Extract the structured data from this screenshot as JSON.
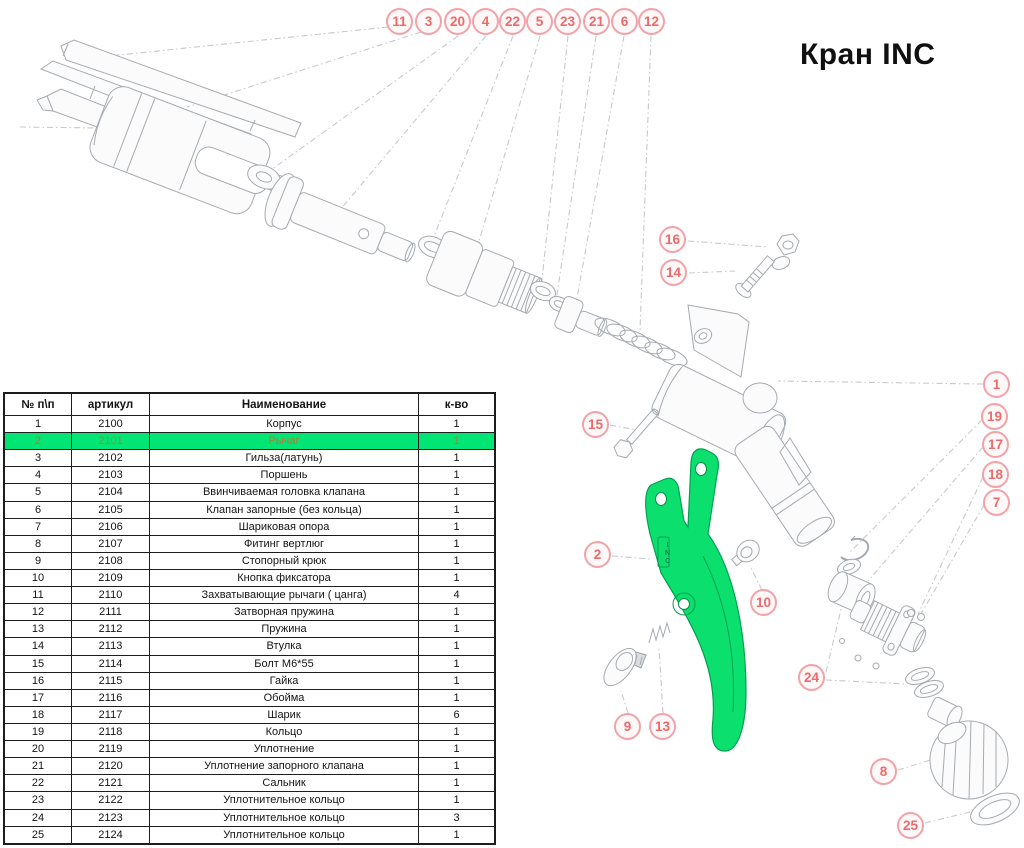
{
  "title": "Кран INC",
  "table": {
    "columns": [
      "№ п\\п",
      "артикул",
      "Наименование",
      "к-во"
    ],
    "highlighted_row_number": 2,
    "rows": [
      [
        1,
        "2100",
        "Корпус",
        "1"
      ],
      [
        2,
        "2101",
        "Рычаг",
        "1"
      ],
      [
        3,
        "2102",
        "Гильза(латунь)",
        "1"
      ],
      [
        4,
        "2103",
        "Поршень",
        "1"
      ],
      [
        5,
        "2104",
        "Ввинчиваемая головка клапана",
        "1"
      ],
      [
        6,
        "2105",
        "Клапан запорные (без кольца)",
        "1"
      ],
      [
        7,
        "2106",
        "Шариковая опора",
        "1"
      ],
      [
        8,
        "2107",
        "Фитинг вертлюг",
        "1"
      ],
      [
        9,
        "2108",
        "Стопорный крюк",
        "1"
      ],
      [
        10,
        "2109",
        "Кнопка фиксатора",
        "1"
      ],
      [
        11,
        "2110",
        "Захватывающие рычаги ( цанга)",
        "4"
      ],
      [
        12,
        "2111",
        "Затворная пружина",
        "1"
      ],
      [
        13,
        "2112",
        "Пружина",
        "1"
      ],
      [
        14,
        "2113",
        "Втулка",
        "1"
      ],
      [
        15,
        "2114",
        "Болт М6*55",
        "1"
      ],
      [
        16,
        "2115",
        "Гайка",
        "1"
      ],
      [
        17,
        "2116",
        "Обойма",
        "1"
      ],
      [
        18,
        "2117",
        "Шарик",
        "6"
      ],
      [
        19,
        "2118",
        "Кольцо",
        "1"
      ],
      [
        20,
        "2119",
        "Уплотнение",
        "1"
      ],
      [
        21,
        "2120",
        "Уплотнение запорного клапана",
        "1"
      ],
      [
        22,
        "2121",
        "Сальник",
        "1"
      ],
      [
        23,
        "2122",
        "Уплотнительное кольцо",
        "1"
      ],
      [
        24,
        "2123",
        "Уплотнительное кольцо",
        "3"
      ],
      [
        25,
        "2124",
        "Уплотнительное кольцо",
        "1"
      ]
    ]
  },
  "callouts": [
    {
      "label": "11",
      "x": 400,
      "y": 22
    },
    {
      "label": "3",
      "x": 429,
      "y": 22
    },
    {
      "label": "20",
      "x": 458,
      "y": 22
    },
    {
      "label": "4",
      "x": 486,
      "y": 22
    },
    {
      "label": "22",
      "x": 513,
      "y": 22
    },
    {
      "label": "5",
      "x": 540,
      "y": 22
    },
    {
      "label": "23",
      "x": 568,
      "y": 22
    },
    {
      "label": "21",
      "x": 597,
      "y": 22
    },
    {
      "label": "6",
      "x": 625,
      "y": 22
    },
    {
      "label": "12",
      "x": 652,
      "y": 22
    },
    {
      "label": "16",
      "x": 673,
      "y": 240
    },
    {
      "label": "14",
      "x": 674,
      "y": 273
    },
    {
      "label": "15",
      "x": 596,
      "y": 425
    },
    {
      "label": "2",
      "x": 598,
      "y": 555
    },
    {
      "label": "10",
      "x": 764,
      "y": 603
    },
    {
      "label": "9",
      "x": 628,
      "y": 727
    },
    {
      "label": "13",
      "x": 663,
      "y": 727
    },
    {
      "label": "1",
      "x": 997,
      "y": 385
    },
    {
      "label": "19",
      "x": 995,
      "y": 417
    },
    {
      "label": "17",
      "x": 996,
      "y": 445
    },
    {
      "label": "18",
      "x": 996,
      "y": 475
    },
    {
      "label": "7",
      "x": 997,
      "y": 503
    },
    {
      "label": "24",
      "x": 812,
      "y": 678
    },
    {
      "label": "8",
      "x": 884,
      "y": 772
    },
    {
      "label": "25",
      "x": 911,
      "y": 826
    }
  ],
  "diagram": {
    "lever_marking": "INC",
    "highlighted_part_label": "Рычаг",
    "highlight_color": "#0BE06F",
    "callout_border_color": "#f2a2a8",
    "callout_text_color": "#ec6a6a"
  }
}
